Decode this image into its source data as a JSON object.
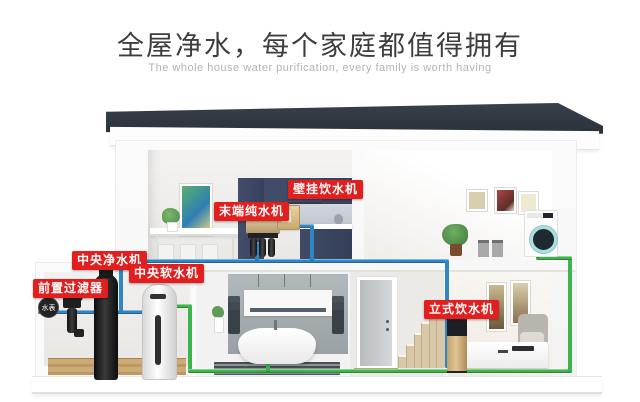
{
  "header": {
    "title": "全屋净水，每个家庭都值得拥有",
    "subtitle": "The whole house water purification, every family is worth having"
  },
  "device_labels": {
    "wall_dispenser": "壁挂饮水机",
    "terminal_purifier": "末端纯水机",
    "central_purifier": "中央净水机",
    "central_softener": "中央软水机",
    "pre_filter": "前置过滤器",
    "standing_dispenser": "立式饮水机",
    "water_meter": "水表"
  },
  "colors": {
    "label_bg": "#e21e1e",
    "label_text": "#ffffff",
    "pipe_raw_water_blue": "#2f86c7",
    "pipe_soft_water_green": "#3eb44d",
    "roof": "#2c343e",
    "kitchen_cabinet_navy": "#3c4760",
    "title_text": "#3d3d3d",
    "subtitle_text": "#b3b3b3"
  }
}
